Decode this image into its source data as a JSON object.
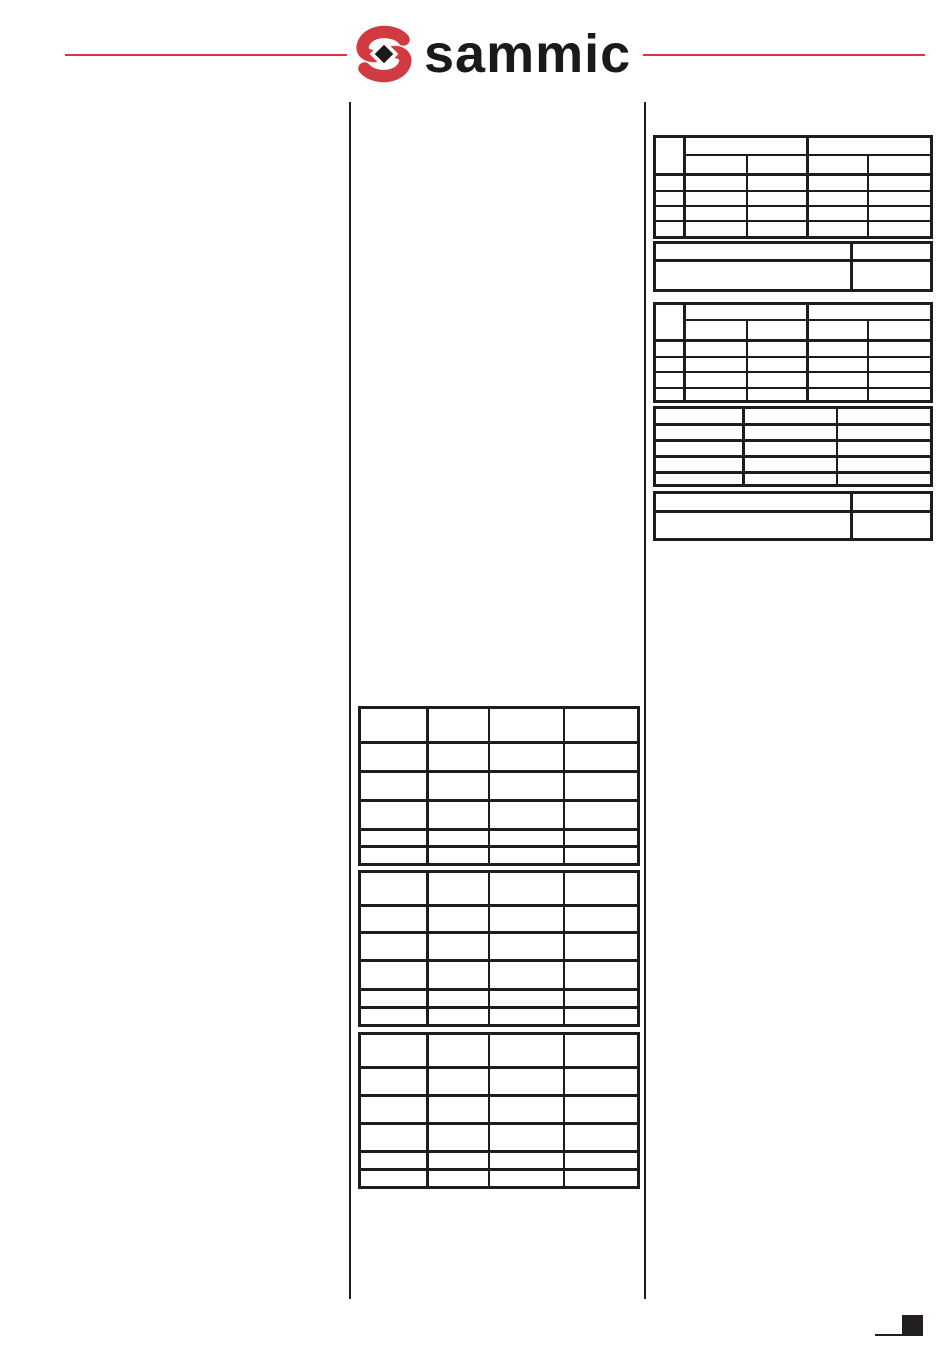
{
  "page": {
    "width": 950,
    "height": 1353,
    "background": "#ffffff"
  },
  "header": {
    "brand_text": "sammic",
    "brand_color": "#1a1a1a",
    "rule_color": "#e63137",
    "logo_mark": {
      "red": "#d23a41",
      "diamond": "#1a1a1a"
    }
  },
  "column_rules": {
    "color": "#1d1d1b"
  },
  "tables_style": {
    "ink": "#1d1d1b"
  },
  "tables": [
    {
      "name": "right-spec-table-1",
      "x": 653,
      "y": 135,
      "grouped": true,
      "cols": [
        30,
        62,
        61,
        60,
        64
      ],
      "rows": [
        18,
        20,
        16,
        15,
        15,
        17
      ],
      "hb": 2,
      "vb": 2,
      "thick_col_lefts": [
        1,
        3
      ],
      "thick_row_tops": [
        2
      ]
    },
    {
      "name": "right-note-table-1",
      "x": 653,
      "y": 241,
      "cols": [
        197,
        80
      ],
      "rows": [
        18,
        30
      ],
      "hb": 3,
      "vb": 3
    },
    {
      "name": "right-spec-table-2",
      "x": 653,
      "y": 302,
      "grouped": true,
      "cols": [
        30,
        62,
        61,
        60,
        64
      ],
      "rows": [
        16,
        21,
        16,
        15,
        16,
        14
      ],
      "hb": 2,
      "vb": 2,
      "thick_col_lefts": [
        1,
        3
      ],
      "thick_row_tops": [
        2
      ]
    },
    {
      "name": "right-three-col-table",
      "x": 653,
      "y": 406,
      "cols": [
        89,
        93,
        95
      ],
      "rows": [
        17,
        16,
        16,
        16,
        13
      ],
      "hb": 3,
      "vb": 2,
      "thick_col_lefts": [
        1
      ],
      "thick_row_tops": [
        1
      ]
    },
    {
      "name": "right-note-table-2",
      "x": 653,
      "y": 491,
      "cols": [
        197,
        80
      ],
      "rows": [
        19,
        28
      ],
      "hb": 3,
      "vb": 3
    },
    {
      "name": "center-table-1",
      "x": 358,
      "y": 706,
      "cols": [
        68,
        61,
        75,
        75
      ],
      "rows": [
        35,
        29,
        29,
        29,
        17,
        18
      ],
      "hb": 3,
      "vb": 2,
      "thick_col_lefts": [
        1
      ],
      "thick_row_tops": [
        1
      ]
    },
    {
      "name": "center-table-2",
      "x": 358,
      "y": 870,
      "cols": [
        68,
        61,
        75,
        75
      ],
      "rows": [
        34,
        27,
        28,
        29,
        18,
        18
      ],
      "hb": 3,
      "vb": 2,
      "thick_col_lefts": [
        1
      ],
      "thick_row_tops": [
        1
      ]
    },
    {
      "name": "center-table-3",
      "x": 358,
      "y": 1032,
      "cols": [
        68,
        61,
        75,
        75
      ],
      "rows": [
        34,
        28,
        28,
        28,
        18,
        18
      ],
      "hb": 3,
      "vb": 2,
      "thick_col_lefts": [
        1
      ],
      "thick_row_tops": [
        1
      ]
    }
  ],
  "footer": {
    "marker_color": "#231f20"
  }
}
